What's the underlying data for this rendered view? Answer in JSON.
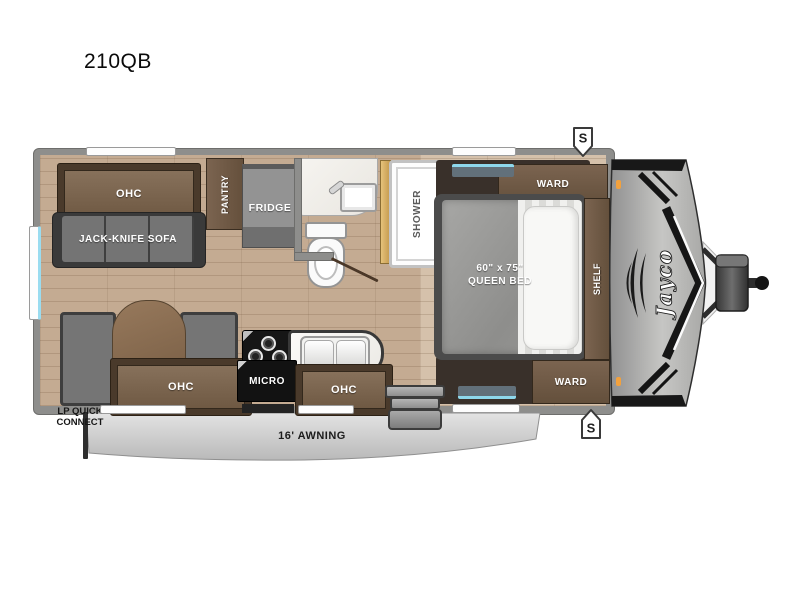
{
  "title": "210QB",
  "brand": "Jayco",
  "speaker": "S",
  "labels": {
    "ohc_rear": "OHC",
    "sofa": "JACK-KNIFE SOFA",
    "pantry": "PANTRY",
    "fridge": "FRIDGE",
    "shower": "SHOWER",
    "ward_top": "WARD",
    "ward_bottom": "WARD",
    "shelf": "SHELF",
    "bed_dims": "60\" x 75\"",
    "bed_type": "QUEEN BED",
    "ohc_dinette": "OHC",
    "micro": "MICRO",
    "ohc_kitchen": "OHC",
    "awning": "16' AWNING",
    "lp_connect_line1": "LP QUICK",
    "lp_connect_line2": "CONNECT"
  },
  "colors": {
    "wall_gray": "#8e8e8c",
    "floor_wood": "#c4ab92",
    "floor_wood_light": "#d5c1ab",
    "cabinet_frame": "#4a3a2b",
    "cabinet_face": "#7c6650",
    "upholstery_gray": "#757575",
    "awning_gray": "#cfcfcf",
    "marker_orange": "#f2a13d",
    "window_cyan": "#8ed8ec",
    "shower_door_gold": "#d9b267"
  }
}
